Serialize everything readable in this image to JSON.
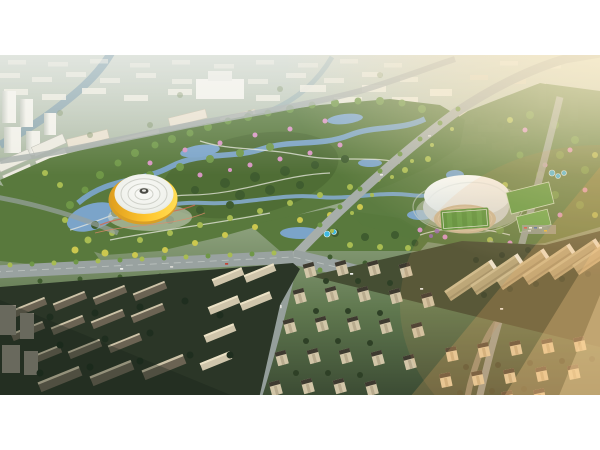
{
  "image": {
    "type": "aerial-architectural-rendering",
    "description": "Bird's-eye architectural rendering at sunset of a planned urban district: a large central riverside park with winding blue waterways, dense green canopy, yellow-green and pink flowering trees; a circular arena with a white ribbed dome and bright yellow facade band sits beside a lake on the west side of the park; a stadium with a white crescent roof, athletics track and green football pitch plus training fields lies on the east side; wide boulevards meet at an interchange south of the park; dense white mid-rise city blocks fade into haze to the north; dark apartment slabs in shadow fill the south-west; rows of beige residential towers fill the south; warm orange sunlight flares from the upper right and streaks across the lower right. White letterbox bars frame the image top and bottom.",
    "elements": [
      {
        "name": "central-park",
        "description": "Landscaped park with winding waterways, paths and flowering trees"
      },
      {
        "name": "dome-arena",
        "description": "Circular arena, white concentric-ring dome roof, yellow facade band, lakeside"
      },
      {
        "name": "stadium",
        "description": "Stadium with white shell roof, tan running track and striped green pitch"
      },
      {
        "name": "training-fields",
        "description": "Green sports fields and courts east of the stadium"
      },
      {
        "name": "nw-river",
        "description": "River flowing from the north-west city into the park"
      },
      {
        "name": "road-network",
        "description": "Wide grey boulevards crossing at an interchange south of the park"
      },
      {
        "name": "north-city-blocks",
        "description": "Dense white mid-rise and high-rise blocks fading into haze"
      },
      {
        "name": "southwest-dark-district",
        "description": "Dark apartment slab rows in shadow"
      },
      {
        "name": "south-residential-towers",
        "description": "Rows of beige towers with dark roofs among trees"
      },
      {
        "name": "east-residential-slabs",
        "description": "Long striped apartment slabs lit by warm low sun"
      },
      {
        "name": "water-park-pools",
        "description": "Small bright blue pool clusters inside the park"
      },
      {
        "name": "sun-glow",
        "description": "Warm orange sunset light from the upper-right corner and lower-right streak"
      }
    ],
    "palette": {
      "white": "#ffffff",
      "base-top": "#cbd3c8",
      "base-mid": "#8da17d",
      "base-dark": "#3c4c34",
      "bldg-white": "#eceade",
      "bldg-cream": "#e9e1cf",
      "bldg-warm": "#dcd3c0",
      "bldg-shadow": "#c3c8bd",
      "park-green": "#59793d",
      "park-green-dark": "#4c6a33",
      "tree-mid": "#6f9747",
      "tree-dark": "#3f5c2f",
      "tree-light": "#a8bc52",
      "tree-yellow": "#ccc84f",
      "tree-pink": "#d795c2",
      "tree-purple": "#9a6ab8",
      "tree-muted": "#7e9266",
      "water": "#7ba4c9",
      "water-2": "#84aacc",
      "water-bright": "#3fb9e2",
      "river": "#8ca7ae",
      "road": "#99a2a0",
      "road-light": "#a7aeaa",
      "road-line": "#c3c9c6",
      "road-dark": "#5e6a60",
      "arena-shadow": "#d99f26",
      "dome-white": "#f4f5f1",
      "dome-ring": "#cfd1c9",
      "stadium-bowl": "#c9cfc9",
      "track": "#c9b896",
      "pitch": "#4e8f37",
      "pitch-light": "#5ca044",
      "ground-dark": "#2b3627",
      "ground-olive": "#454e33",
      "res-beige": "#d2c6a8",
      "roof-dark": "#3e3a30",
      "res-warm": "#e3d2a8",
      "slab-dark": "#6b6353",
      "slab-top": "#cdc3a8",
      "slab-beige": "#cfc5ab",
      "path-white": "#e9e9df",
      "jog-red": "#d06a52",
      "glow": "#f6b168",
      "glow-soft": "#ffcf8e",
      "sun": "#ffeec6",
      "shadow-corner": "#142017"
    }
  }
}
